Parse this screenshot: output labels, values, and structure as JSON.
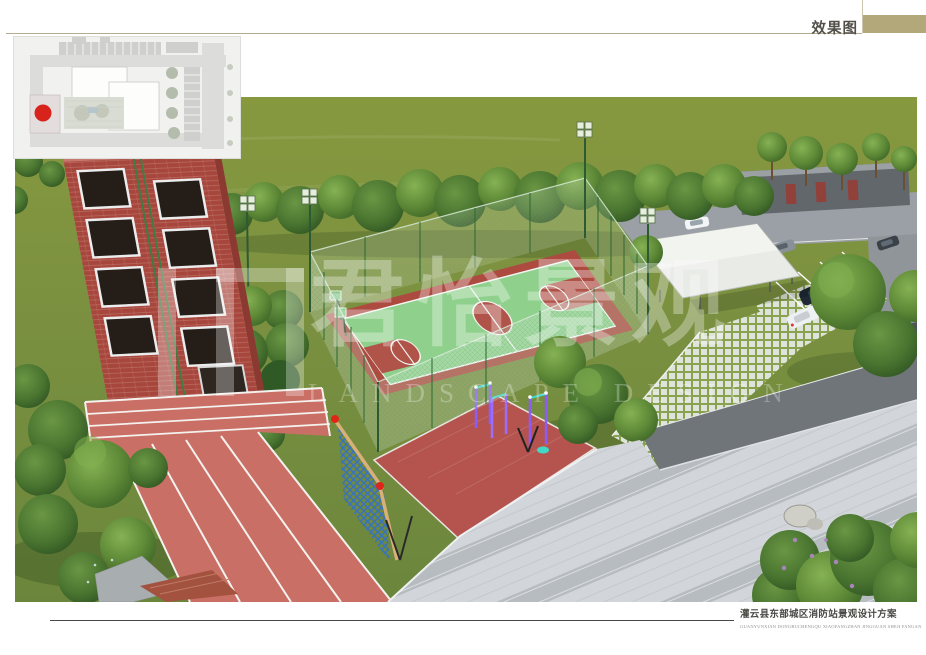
{
  "header": {
    "title": "效果图",
    "accent_color": "#b2a87a"
  },
  "watermark": {
    "brand_cn": "君怡景观",
    "brand_en": "LANDSCAPE DESIGN"
  },
  "footer": {
    "title_cn": "灌云县东部城区消防站景观设计方案",
    "title_en": "GUANYUNXIAN DONGBUCHENGQU XIAOFANGZHAN JINGGUAN SHEJI FANGAN"
  },
  "scene": {
    "colors": {
      "grass": "#7c9140",
      "court_green": "#8fd08d",
      "court_red": "#ad4b41",
      "track_red": "#c96f65",
      "fitness_plaza_red": "#b5544e",
      "tower_brick": "#a7463c",
      "pavement_gray": "#ced3d7",
      "asphalt": "#70757a",
      "canopy_white": "#e9ebe7",
      "site_marker_red": "#d8231c",
      "net_blue": "#2f6fd0",
      "equipment_purple": "#8b5cf6"
    }
  }
}
